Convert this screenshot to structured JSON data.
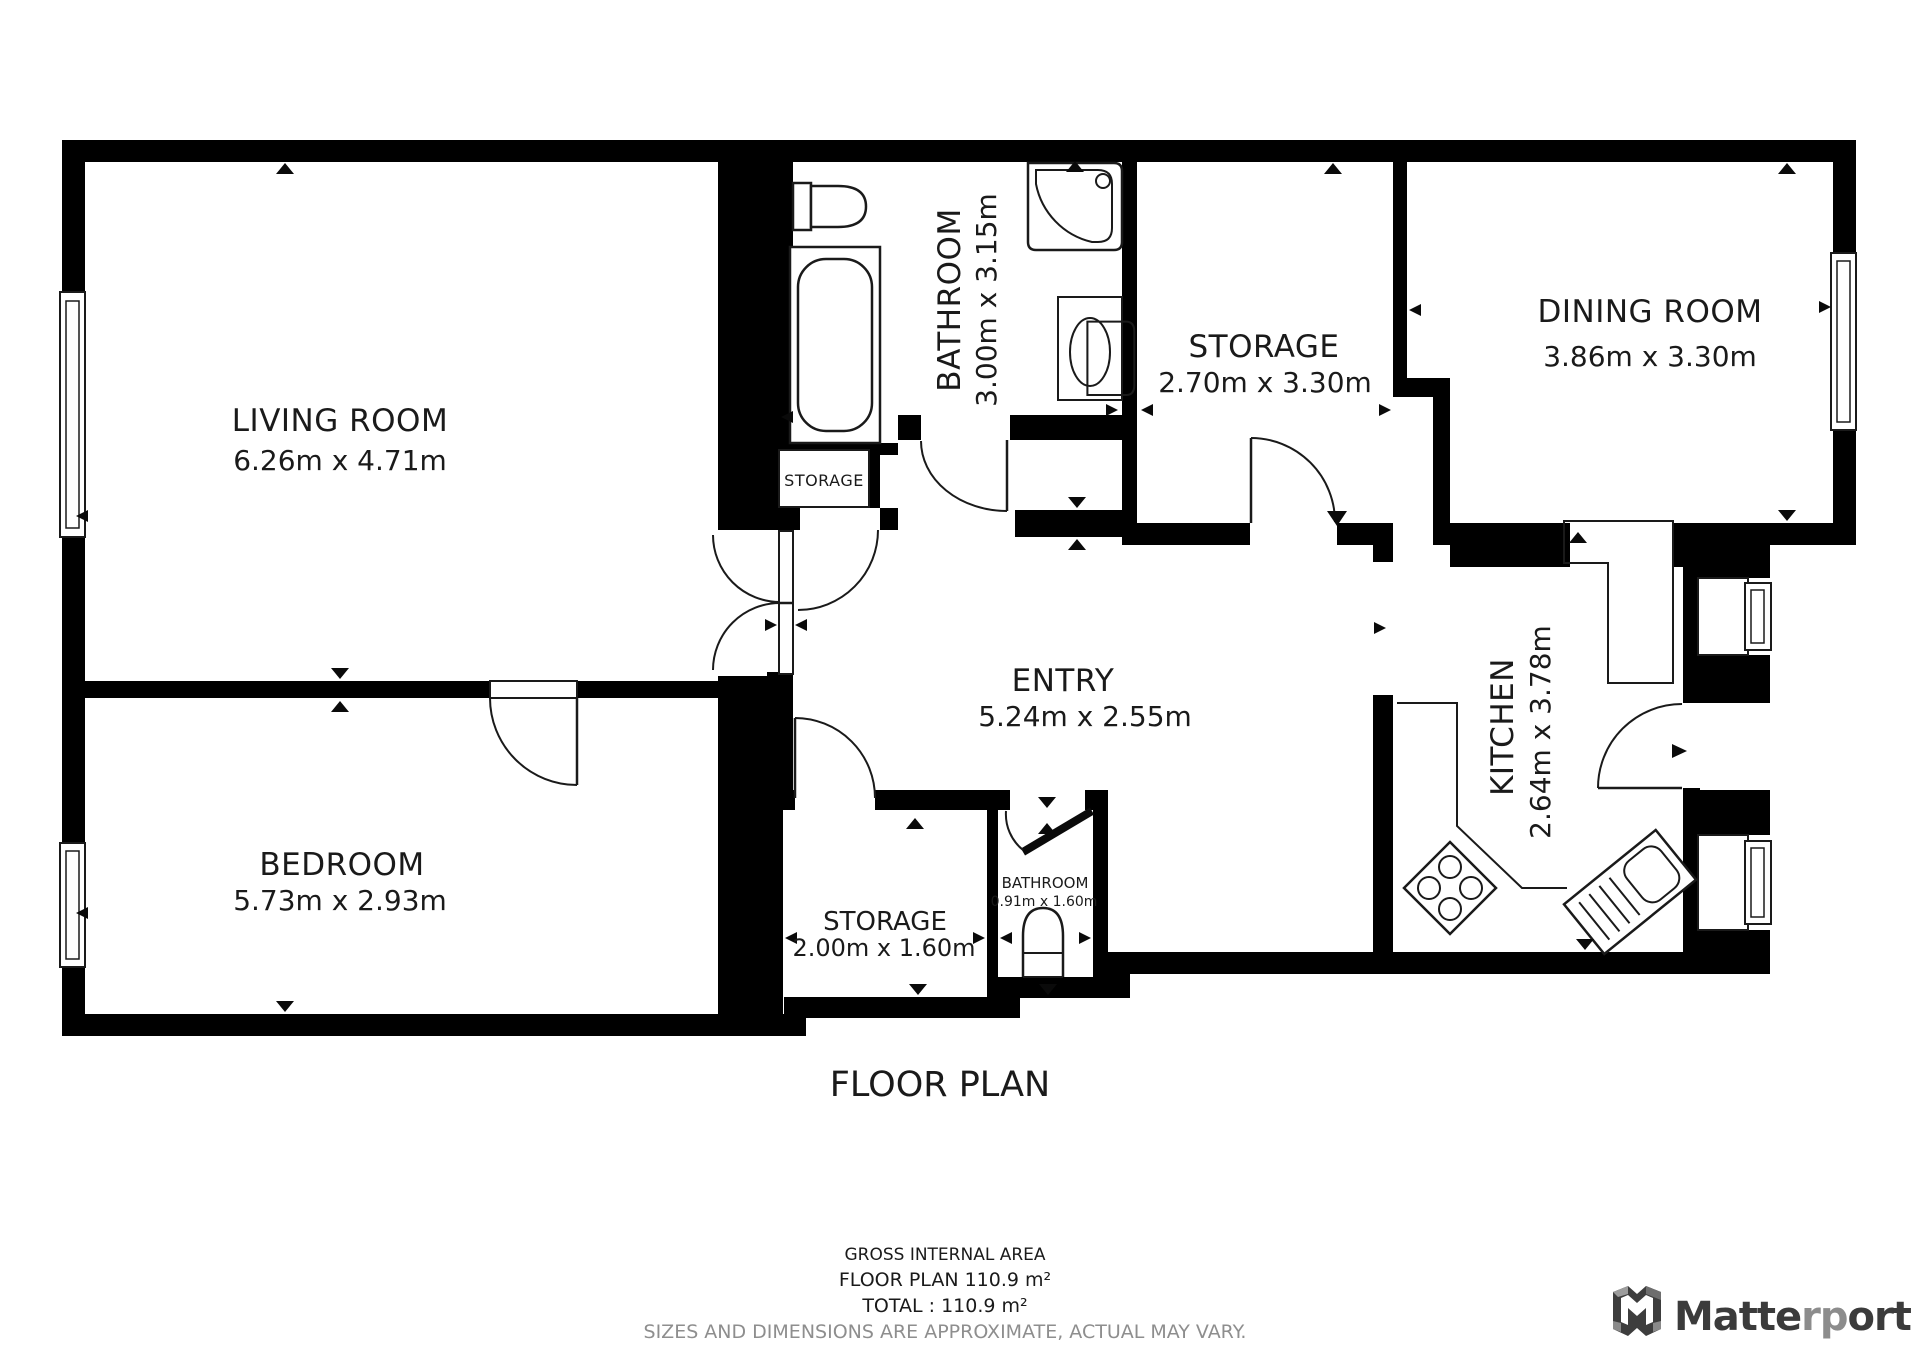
{
  "title": "FLOOR PLAN",
  "rooms": {
    "living": {
      "name": "LIVING ROOM",
      "dims": "6.26m x 4.71m"
    },
    "bedroom": {
      "name": "BEDROOM",
      "dims": "5.73m x 2.93m"
    },
    "entry": {
      "name": "ENTRY",
      "dims": "5.24m x 2.55m"
    },
    "bathroom": {
      "name": "BATHROOM",
      "dims": "3.00m x 3.15m"
    },
    "storage_hall": {
      "name": "STORAGE",
      "dims": "2.70m x 3.30m"
    },
    "dining": {
      "name": "DINING ROOM",
      "dims": "3.86m x 3.30m"
    },
    "kitchen": {
      "name": "KITCHEN",
      "dims": "2.64m x 3.78m"
    },
    "storage_south": {
      "name": "STORAGE",
      "dims": "2.00m x 1.60m"
    },
    "bathroom_small": {
      "name": "BATHROOM",
      "dims": "0.91m x 1.60m"
    },
    "closet": {
      "name": "STORAGE"
    }
  },
  "footer": {
    "gross_area_label": "GROSS INTERNAL AREA",
    "floor_plan_area": "FLOOR PLAN 110.9 m²",
    "total_area": "TOTAL :  110.9 m²",
    "disclaimer": "SIZES AND DIMENSIONS ARE APPROXIMATE, ACTUAL MAY VARY."
  },
  "branding": {
    "name_part1": "Matte",
    "name_part2": "rp",
    "name_part3": "ort"
  },
  "colors": {
    "wall": "#000000",
    "text": "#1a1a1a",
    "disclaimer_gray": "#8e8e8e",
    "brand_dark": "#3b3b3b",
    "brand_gray": "#8c8c8c"
  }
}
